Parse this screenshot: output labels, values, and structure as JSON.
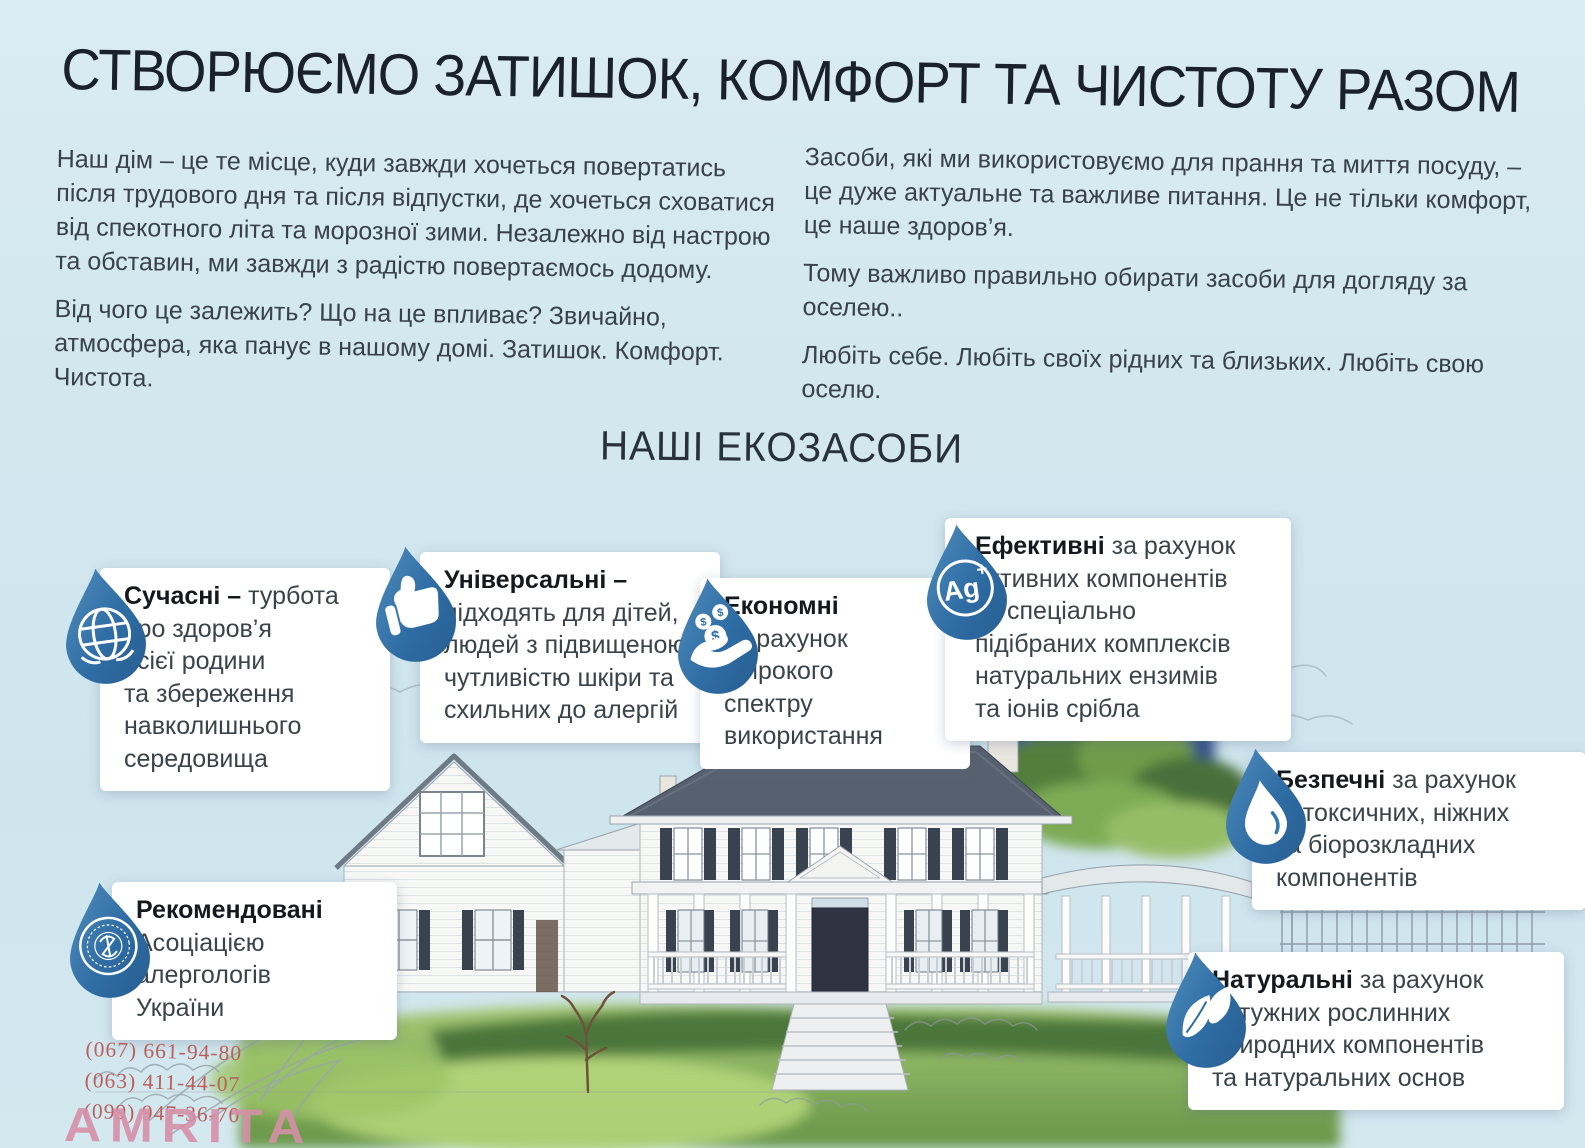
{
  "header": {
    "title": "СТВОРЮЄМО ЗАТИШОК, КОМФОРТ ТА ЧИСТОТУ РАЗОМ"
  },
  "intro": {
    "left": [
      "Наш дім – це те місце, куди завжди хочеться повертатись після трудового дня та після відпустки, де хочеться сховатися від спекотного літа та морозної зими. Незалежно від настрою та обставин, ми завжди з радістю повертаємось додому.",
      "Від чого це залежить? Що на це впливає? Звичайно, атмосфера, яка панує в нашому домі. Затишок. Комфорт. Чистота."
    ],
    "right": [
      "Засоби, які ми використовуємо для прання та миття посуду, – це дуже актуальне та важливе питання. Це не тільки комфорт, це наше здоров’я.",
      "Тому важливо правильно обирати засоби для догляду за оселею..",
      "Любіть себе. Любіть своїх рідних та близьких. Любіть свою оселю."
    ]
  },
  "section": {
    "heading": "НАШІ ЕКОЗАСОБИ"
  },
  "cards": [
    {
      "icon": "globe-drop-icon",
      "title": "Сучасні –",
      "body": " турбота\nпро здоров’я\nвсієї родини\nта збереження\nнавколишнього\nсередовища"
    },
    {
      "icon": "thumbs-up-drop-icon",
      "title": "Універсальні –",
      "body": "\nпідходять для дітей,\nлюдей з підвищеною\nчутливістю шкіри та\nсхильних до алергій"
    },
    {
      "icon": "coins-hand-drop-icon",
      "title": "Економні",
      "body": "\nза рахунок\nширокого\nспектру\nвикористання",
      "coin_symbol": "$"
    },
    {
      "icon": "silver-ion-drop-icon",
      "title": "Ефективні",
      "body": " за рахунок\nактивних компонентів\nта спеціально\nпідібраних комплексів\nнатуральних ензимів\nта іонів срібла",
      "badge": {
        "symbol": "Ag",
        "charge": "+"
      }
    },
    {
      "icon": "water-drop-icon",
      "title": "Безпечні",
      "body": " за рахунок\nнетоксичних, ніжних\nта біорозкладних\nкомпонентів"
    },
    {
      "icon": "association-seal-drop-icon",
      "title": "Рекомендовані",
      "body": "\nАсоціацією\nалергологів\nУкраїни"
    },
    {
      "icon": "leaf-drop-icon",
      "title": "Натуральні",
      "body": " за рахунок\nпотужних рослинних\nприродних компонентів\nта натуральних основ"
    }
  ],
  "contacts": {
    "phones": [
      "(067) 661-94-80",
      "(063) 411-44-07",
      "(099) 947-36-70"
    ]
  },
  "watermark": {
    "text": "AMRITA"
  },
  "colors": {
    "background": "#d3e7ee",
    "drop_blue": "#2f6da5",
    "drop_blue_light": "#5590bd",
    "card_background": "#ffffff",
    "title_text": "#1a212b",
    "body_text": "#3b4349",
    "phone_text": "#bd5f5c",
    "watermark_pink": "#d690a8"
  }
}
